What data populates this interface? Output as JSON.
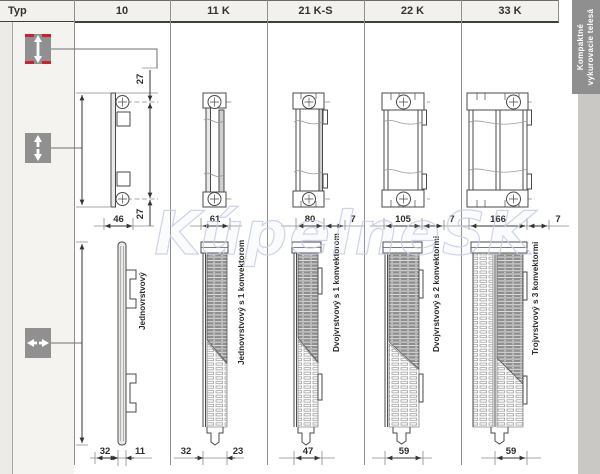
{
  "header": {
    "typ": "Typ"
  },
  "types": [
    {
      "code": "10",
      "label": "Jednovrstvový",
      "dims": {
        "offset_top": "27",
        "offset_bottom": "27",
        "depth_top": "46",
        "front": "32",
        "back": "11"
      }
    },
    {
      "code": "11 K",
      "label": "Jednovrstvový s 1 konvektorom",
      "dims": {
        "depth_top": "61",
        "front": "32",
        "back": "23"
      }
    },
    {
      "code": "21 K-S",
      "label": "Dvojvrstvový s 1 konvektorom",
      "dims": {
        "depth_top": "80",
        "wall_gap": "7",
        "depth_bottom": "47"
      }
    },
    {
      "code": "22 K",
      "label": "Dvojvrstvový s 2 konvektormi",
      "dims": {
        "depth_top": "105",
        "wall_gap": "7",
        "depth_bottom": "59"
      }
    },
    {
      "code": "33 K",
      "label": "Trojvrstvový s 3 konvektormi",
      "dims": {
        "depth_top": "166",
        "wall_gap": "7",
        "depth_bottom": "59"
      }
    }
  ],
  "sidebar": {
    "line1": "Kompaktné",
    "line2": "vykurovacie telesá"
  },
  "watermark": {
    "text": "KúpelneSK"
  },
  "colors": {
    "accent_red": "#cd2130",
    "sidebar_tab": "#8f8f8f",
    "header_bg": "#f2f1ee"
  }
}
